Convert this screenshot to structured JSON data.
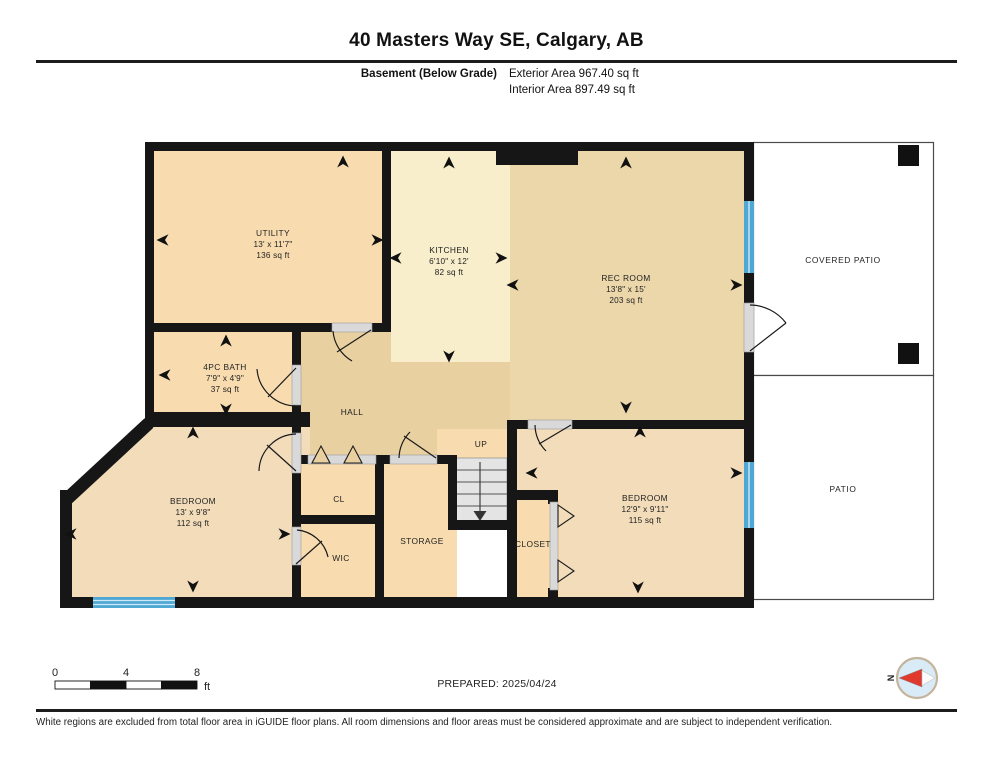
{
  "header": {
    "title": "40 Masters Way SE, Calgary, AB",
    "floor_label": "Basement (Below Grade)",
    "exterior_area": "Exterior Area 967.40 sq ft",
    "interior_area": "Interior Area 897.49 sq ft"
  },
  "rooms": [
    {
      "name": "UTILITY",
      "dims": "13' x 11'7\"",
      "area": "136 sq ft"
    },
    {
      "name": "KITCHEN",
      "dims": "6'10\" x 12'",
      "area": "82 sq ft"
    },
    {
      "name": "REC ROOM",
      "dims": "13'8\" x 15'",
      "area": "203 sq ft"
    },
    {
      "name": "4PC BATH",
      "dims": "7'9\" x 4'9\"",
      "area": "37 sq ft"
    },
    {
      "name": "BEDROOM",
      "dims": "13' x 9'8\"",
      "area": "112 sq ft"
    },
    {
      "name": "BEDROOM",
      "dims": "12'9\" x 9'11\"",
      "area": "115 sq ft"
    }
  ],
  "labels": {
    "hall": "HALL",
    "up": "UP",
    "cl": "CL",
    "wic": "WIC",
    "storage": "STORAGE",
    "closet": "CLOSET",
    "covered_patio": "COVERED PATIO",
    "patio": "PATIO"
  },
  "scale_bar": {
    "ticks": [
      "0",
      "4",
      "8"
    ],
    "unit": "ft"
  },
  "prepared": "PREPARED: 2025/04/24",
  "compass": {
    "north": "N"
  },
  "footer": {
    "disclaimer": "White regions are excluded from total floor area in iGUIDE floor plans. All room dimensions and floor areas must be considered approximate and are subject to independent verification."
  },
  "colors": {
    "wall": "#161616",
    "peach": "#f8dcb0",
    "beige": "#f2dcba",
    "rec_tan": "#ecd7ab",
    "hall_tan": "#e9d0a0",
    "kitchen_cream": "#f8eecb",
    "window_blue": "#4fa8d4",
    "stair_gray": "#e4e4e4",
    "compass_red": "#e03a2f"
  }
}
